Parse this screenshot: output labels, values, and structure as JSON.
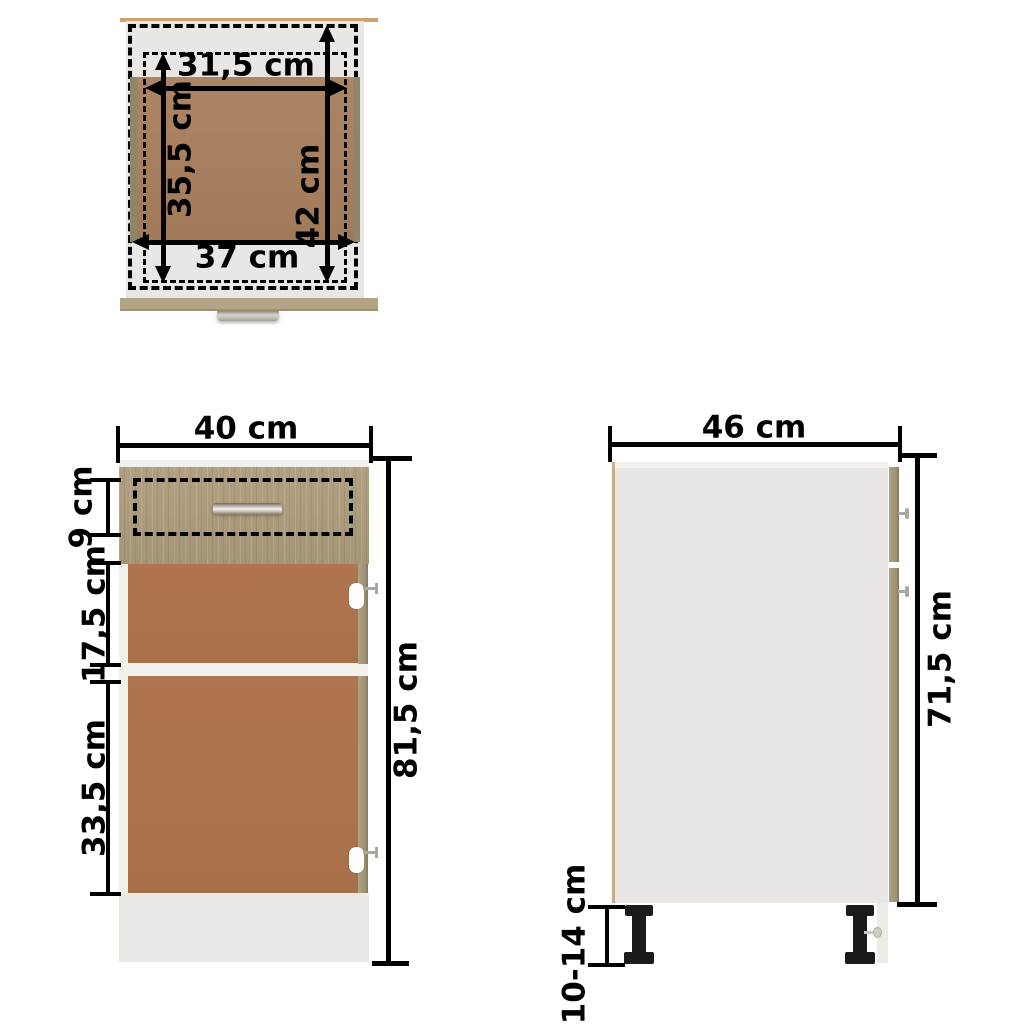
{
  "diagram": {
    "title": "cabinet-dimension-diagram",
    "top_view": {
      "inner_width": "31,5 cm",
      "inner_depth": "35,5 cm",
      "full_depth": "42 cm",
      "outer_width": "37 cm"
    },
    "front_view": {
      "width": "40 cm",
      "drawer_height": "9 cm",
      "upper_section_height": "17,5 cm",
      "lower_section_height": "33,5 cm",
      "total_height": "81,5 cm"
    },
    "side_view": {
      "depth": "46 cm",
      "body_height": "71,5 cm",
      "leg_height": "10-14 cm"
    },
    "colors": {
      "oak": "#a89878",
      "interior_brown": "#ad734e",
      "drawer_bottom_brown": "#a98262",
      "panel_gray": "#e9e7e5",
      "dimension_black": "#000000"
    }
  }
}
